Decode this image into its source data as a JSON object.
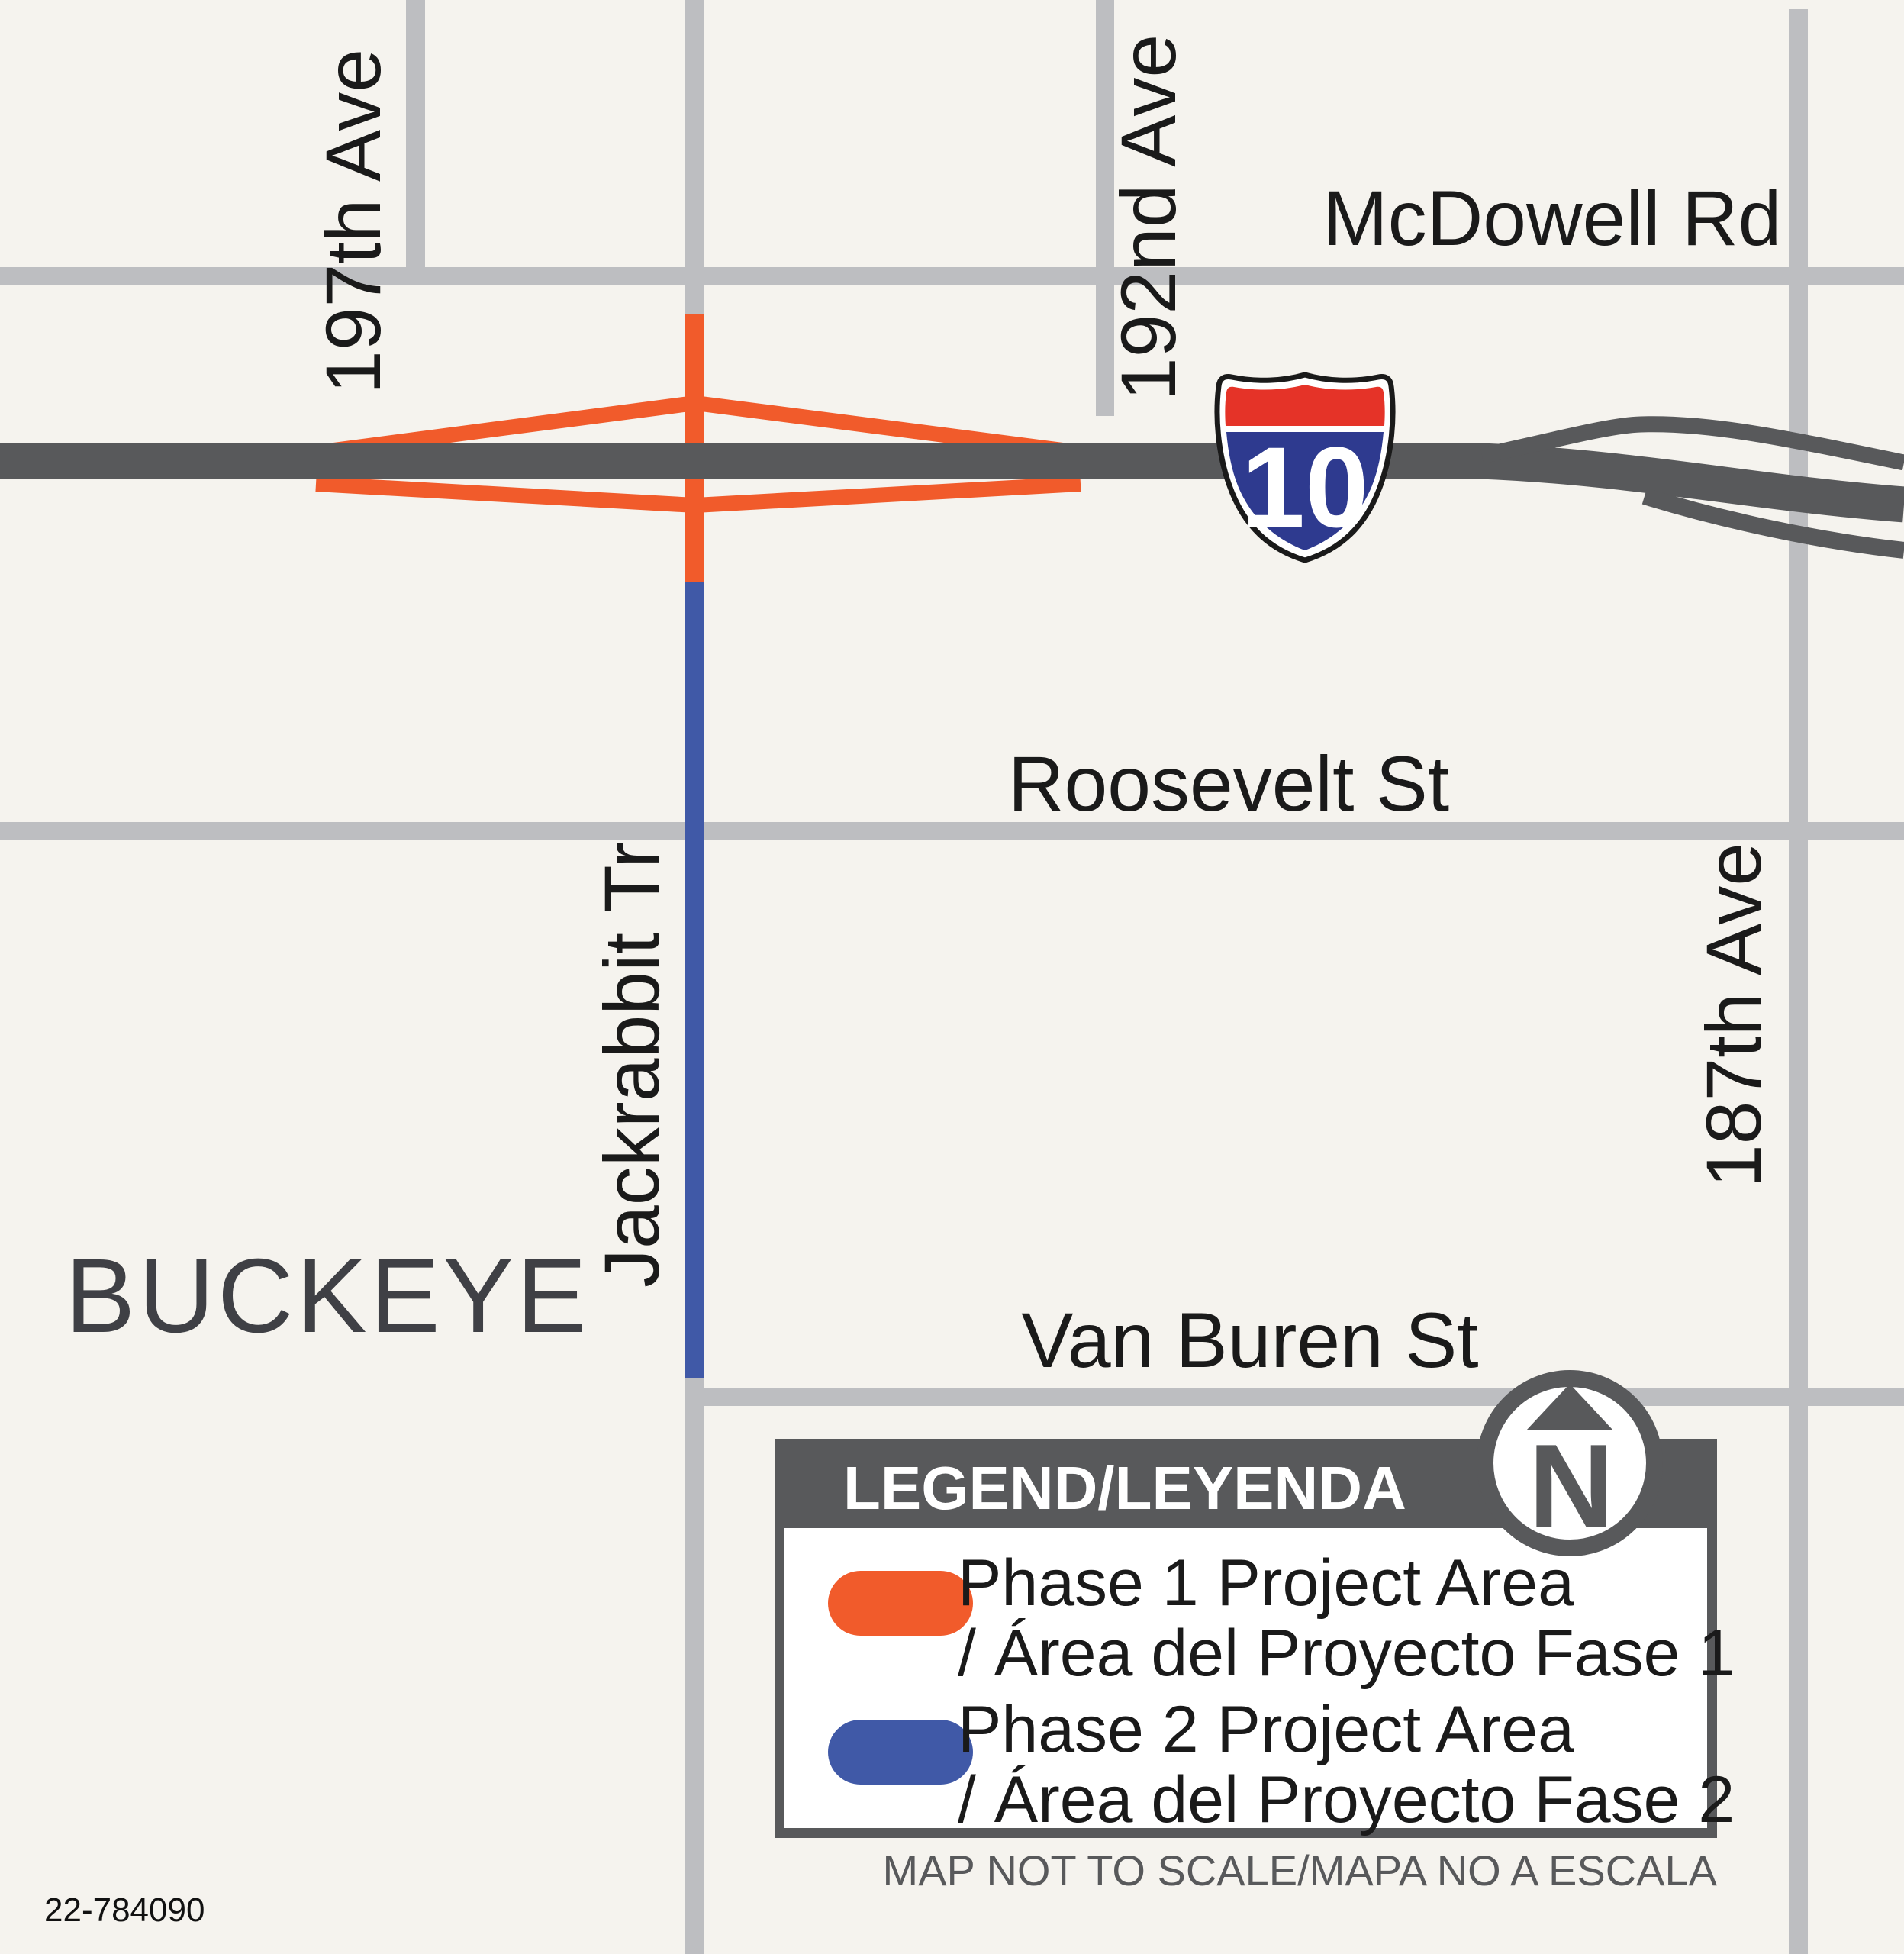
{
  "map": {
    "city_label": "BUCKEYE",
    "plate_number": "22-784090",
    "streets": {
      "mcdowell": "McDowell Rd",
      "roosevelt": "Roosevelt St",
      "van_buren": "Van Buren St",
      "ave_197": "197th Ave",
      "ave_192": "192nd Ave",
      "ave_187": "187th Ave",
      "jackrabbit": "Jackrabbit Tr"
    },
    "interstate_shield": "10",
    "north_indicator": "N"
  },
  "legend": {
    "title": "LEGEND/LEYENDA",
    "items": [
      {
        "label_line1": "Phase 1 Project Area",
        "label_line2": "/ Área del Proyecto Fase 1",
        "color": "#F15B2B"
      },
      {
        "label_line1": "Phase 2 Project Area",
        "label_line2": "/ Área del Proyecto Fase 2",
        "color": "#4059A7"
      }
    ],
    "note": "MAP NOT TO SCALE/MAPA NO A ESCALA"
  },
  "colors": {
    "background": "#F5F3EE",
    "local_road_gray": "#BDBEC1",
    "highway_dark_gray": "#58595B",
    "phase1_orange": "#F15B2B",
    "phase2_blue": "#4059A7",
    "shield_red": "#E53328",
    "shield_blue": "#2E3A8F",
    "label_text": "#1A1A1A",
    "city_text": "#3F4045"
  }
}
